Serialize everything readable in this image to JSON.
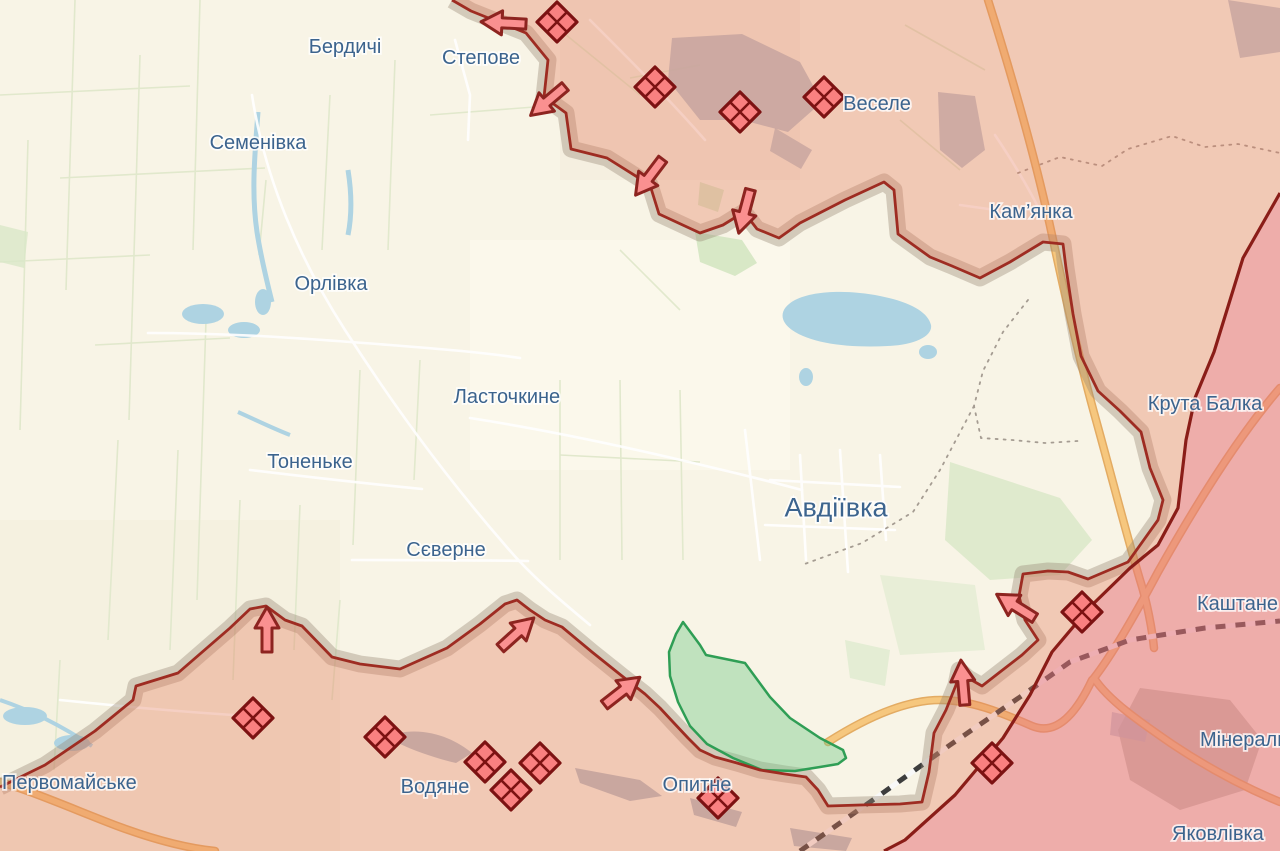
{
  "map": {
    "region": "Avdiivka direction frontline map",
    "label_default_size": 20,
    "labels": [
      {
        "id": "berdychi",
        "text": "Бердичі",
        "x": 345,
        "y": 46,
        "anchor": "middle"
      },
      {
        "id": "stepove",
        "text": "Степове",
        "x": 481,
        "y": 57,
        "anchor": "middle"
      },
      {
        "id": "semenivka",
        "text": "Семенівка",
        "x": 258,
        "y": 142,
        "anchor": "middle"
      },
      {
        "id": "orlivka",
        "text": "Орлівка",
        "x": 331,
        "y": 283,
        "anchor": "middle"
      },
      {
        "id": "lastochkyne",
        "text": "Ласточкине",
        "x": 507,
        "y": 396,
        "anchor": "middle"
      },
      {
        "id": "tonenke",
        "text": "Тоненьке",
        "x": 310,
        "y": 461,
        "anchor": "middle"
      },
      {
        "id": "sieverne",
        "text": "Сєверне",
        "x": 446,
        "y": 549,
        "anchor": "middle"
      },
      {
        "id": "avdiivka",
        "text": "Авдіївка",
        "x": 836,
        "y": 507,
        "anchor": "middle",
        "size": 27
      },
      {
        "id": "vesele",
        "text": "Веселе",
        "x": 877,
        "y": 103,
        "anchor": "middle"
      },
      {
        "id": "kamianka",
        "text": "Кам’янка",
        "x": 1031,
        "y": 211,
        "anchor": "middle"
      },
      {
        "id": "kruta-balka",
        "text": "Крута Балка",
        "x": 1205,
        "y": 403,
        "anchor": "middle"
      },
      {
        "id": "kashtane",
        "text": "Каштане",
        "x": 1197,
        "y": 603,
        "anchor": "start"
      },
      {
        "id": "mineralne",
        "text": "Мінеральне",
        "x": 1200,
        "y": 739,
        "anchor": "start"
      },
      {
        "id": "yakovlivka",
        "text": "Яковлівка",
        "x": 1172,
        "y": 833,
        "anchor": "start"
      },
      {
        "id": "pervomaiske",
        "text": "Первомайське",
        "x": 2,
        "y": 782,
        "anchor": "start"
      },
      {
        "id": "vodiane",
        "text": "Водяне",
        "x": 435,
        "y": 786,
        "anchor": "middle"
      },
      {
        "id": "opytne",
        "text": "Опитне",
        "x": 697,
        "y": 784,
        "anchor": "middle"
      }
    ],
    "clash_markers": [
      {
        "x": 557,
        "y": 22
      },
      {
        "x": 655,
        "y": 87
      },
      {
        "x": 740,
        "y": 112
      },
      {
        "x": 824,
        "y": 97
      },
      {
        "x": 253,
        "y": 718
      },
      {
        "x": 385,
        "y": 737
      },
      {
        "x": 485,
        "y": 762
      },
      {
        "x": 540,
        "y": 763
      },
      {
        "x": 511,
        "y": 790
      },
      {
        "x": 718,
        "y": 798
      },
      {
        "x": 1082,
        "y": 612
      },
      {
        "x": 992,
        "y": 763
      }
    ],
    "attack_arrows": [
      {
        "x": 505,
        "y": 23,
        "angle": 183
      },
      {
        "x": 549,
        "y": 100,
        "angle": 140
      },
      {
        "x": 650,
        "y": 176,
        "angle": 127
      },
      {
        "x": 745,
        "y": 210,
        "angle": 105
      },
      {
        "x": 267,
        "y": 631,
        "angle": 270
      },
      {
        "x": 516,
        "y": 634,
        "angle": 318
      },
      {
        "x": 621,
        "y": 692,
        "angle": 322
      },
      {
        "x": 1017,
        "y": 607,
        "angle": 212
      },
      {
        "x": 963,
        "y": 684,
        "angle": 265
      }
    ],
    "zones": {
      "occupied": {
        "name": "occupied territory",
        "fill": "#f2ccba",
        "border": "#9e2c22"
      },
      "occupied_pre_2022": {
        "name": "occupied before 24.02.2022",
        "fill": "#f3cbd3",
        "border": "#8a1d18"
      },
      "liberated": {
        "name": "liberated / green zone",
        "fill": "#c9e8c9",
        "border": "#2f9e55"
      },
      "gray_buffer": {
        "name": "contested buffer strip",
        "fill": "#ddd5c7"
      }
    },
    "icon_colors": {
      "clash_marker_fill": "#f98080",
      "clash_marker_border": "#7c1212",
      "attack_arrow_fill": "#fa9090",
      "attack_arrow_border": "#8d2420",
      "label_color": "#3c648e",
      "highway_color": "#f6c77e",
      "water_color": "#aed3e2"
    }
  }
}
